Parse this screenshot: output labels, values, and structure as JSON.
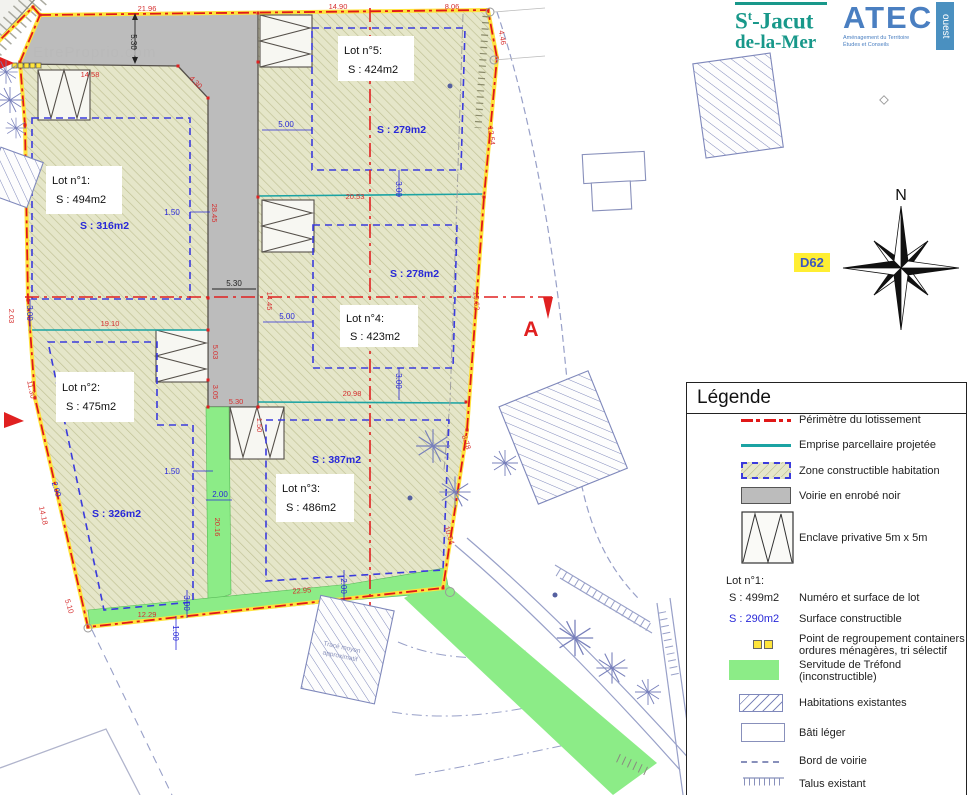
{
  "watermark": "EtreProprio.com",
  "logos": {
    "commune": {
      "p1": "S",
      "sup": "t",
      "p2": "-Jacut",
      "line2": "de-la-Mer"
    },
    "atec": {
      "name": "ATEC",
      "vertical": "ouest",
      "sub1": "Aménagement du Territoire",
      "sub2": "Études et Conseils"
    }
  },
  "map": {
    "north": "N",
    "d62": "D62",
    "section_a": "A",
    "section_b": "B",
    "note1": "Tracé moyen",
    "note2": "approximatif",
    "lots": [
      {
        "name": "Lot n°1:",
        "surface": "S : 494m2",
        "constructible": "S : 316m2"
      },
      {
        "name": "Lot n°2:",
        "surface": "S : 475m2",
        "constructible": "S : 326m2"
      },
      {
        "name": "Lot n°3:",
        "surface": "S : 486m2",
        "constructible": "S : 387m2"
      },
      {
        "name": "Lot n°4:",
        "surface": "S : 423m2",
        "constructible": "S : 278m2"
      },
      {
        "name": "Lot n°5:",
        "surface": "S : 424m2",
        "constructible": "S : 279m2"
      }
    ],
    "dims_red": [
      {
        "t": "21.96"
      },
      {
        "t": "14.90"
      },
      {
        "t": "8.06"
      },
      {
        "t": "14.58"
      },
      {
        "t": "20.53"
      },
      {
        "t": "20.98"
      },
      {
        "t": "19.10"
      },
      {
        "t": "22.95"
      },
      {
        "t": "12.29"
      },
      {
        "t": "5.10"
      },
      {
        "t": "11.30"
      },
      {
        "t": "14.18"
      },
      {
        "t": "2.03"
      },
      {
        "t": "28.45"
      },
      {
        "t": "14.45"
      },
      {
        "t": "5.03"
      },
      {
        "t": "3.05"
      },
      {
        "t": "5.30"
      },
      {
        "t": "1.50"
      },
      {
        "t": "20.16"
      },
      {
        "t": "19.62"
      },
      {
        "t": "12.54"
      },
      {
        "t": "4.46"
      },
      {
        "t": "10.64"
      },
      {
        "t": "8.78"
      },
      {
        "t": "4.30"
      }
    ],
    "dims_blue": [
      {
        "t": "5.00"
      },
      {
        "t": "5.00"
      },
      {
        "t": "3.00"
      },
      {
        "t": "3.00"
      },
      {
        "t": "3.00"
      },
      {
        "t": "3.00"
      },
      {
        "t": "1.00"
      },
      {
        "t": "2.00"
      },
      {
        "t": "2.00"
      },
      {
        "t": "2.00"
      },
      {
        "t": "1.50"
      },
      {
        "t": "1.50"
      }
    ],
    "dims_black": [
      {
        "t": "5.30"
      },
      {
        "t": "5.30"
      }
    ]
  },
  "legend": {
    "title": "Légende",
    "perimetre": "Périmètre du lotissement",
    "emprise": "Emprise parcellaire projetée",
    "zone": "Zone constructible habitation",
    "voirie": "Voirie en enrobé noir",
    "enclave": "Enclave privative 5m x 5m",
    "lot_name": "Lot n°1:",
    "lot_surface": "S : 499m2",
    "lot_label": "Numéro et surface de lot",
    "constructible_value": "S : 290m2",
    "constructible_label": "Surface constructible",
    "containers1": "Point de regroupement containers",
    "containers2": "ordures ménagères, tri sélectif",
    "servitude1": "Servitude de Tréfond",
    "servitude2": "(inconstructible)",
    "habitations": "Habitations existantes",
    "bati": "Bâti léger",
    "bord": "Bord de voirie",
    "talus": "Talus existant"
  }
}
